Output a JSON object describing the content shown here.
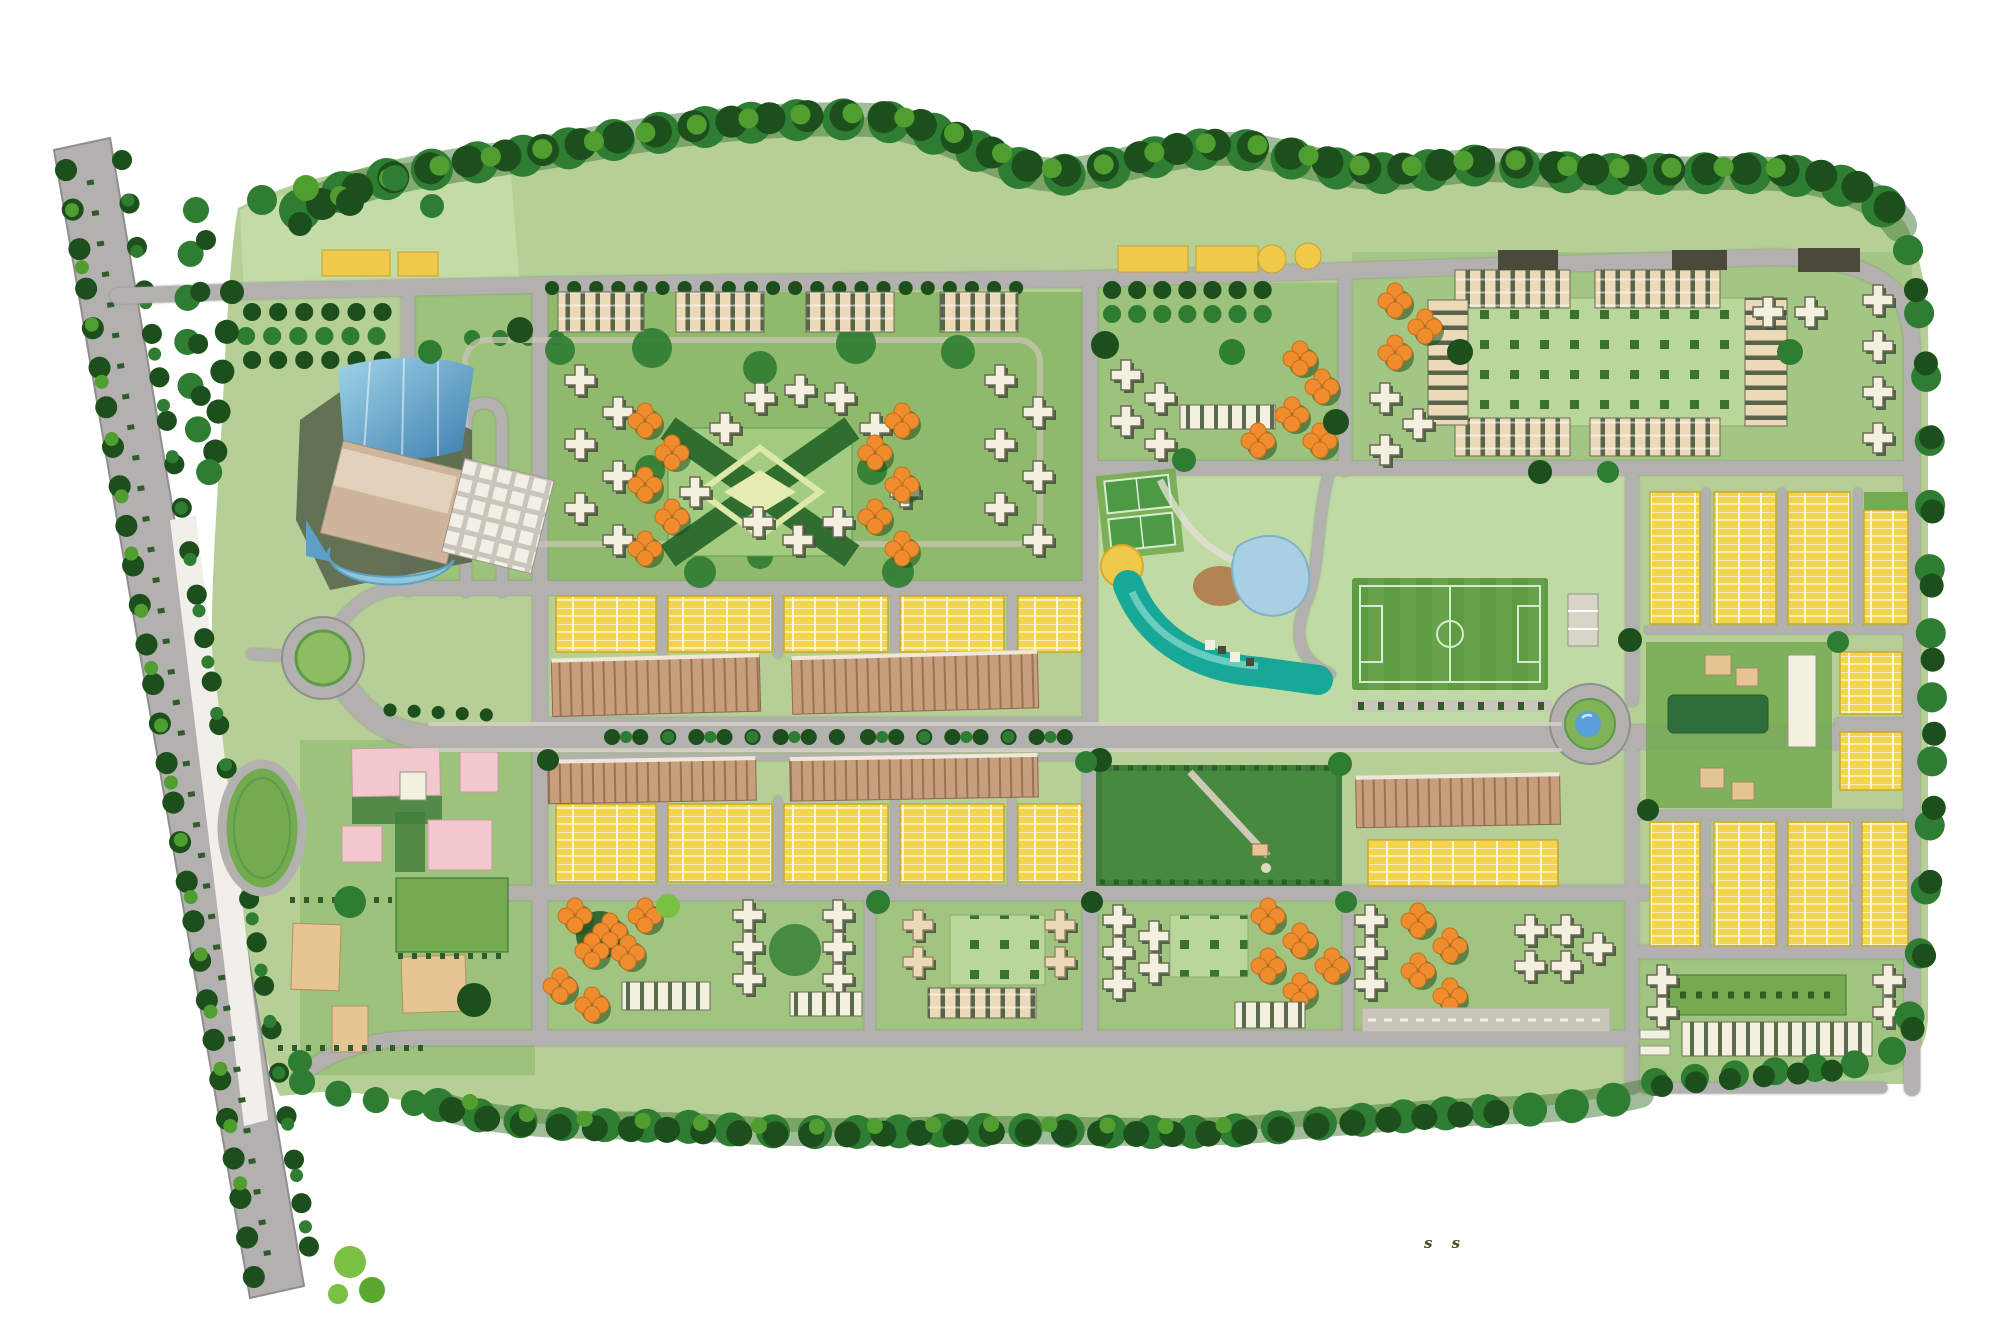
{
  "title": "township master plan",
  "annotations": {
    "plot_mark": "s s"
  },
  "colors": {
    "bg": "#ffffff",
    "grass": "#b5cf96",
    "grassLight": "#c3dca6",
    "grassMid": "#9cc27c",
    "grassDark": "#74ab50",
    "blockGreen": "#8fba6b",
    "parkDark": "#3e7d3a",
    "canopy": "#437a35",
    "treeDark": "#1d4f1d",
    "treeMid": "#2e7d32",
    "treeLight": "#4f9e2f",
    "treeLime": "#7ac143",
    "road": "#b2b1af",
    "roadEdge": "#8f8e8c",
    "lane": "#c6c3b8",
    "sidewalk": "#d6d3c8",
    "plotYellow": "#f3d44d",
    "plotLine": "#fdf6d8",
    "plotEdge": "#caa62e",
    "tan": "#c79f7c",
    "tanLine": "#9a7354",
    "bldgWhite": "#f4f0df",
    "bldgEdge": "#6b6b57",
    "bldgShadow": "#44513b",
    "beige": "#ecd9b8",
    "beigeDark": "#57644a",
    "roofDark": "#4a4a3a",
    "orange": "#ef8c2e",
    "orangeEdge": "#c96f1a",
    "pink": "#f3c7ce",
    "pinkEdge": "#c79aa4",
    "sand": "#e6c593",
    "sandEdge": "#b29260",
    "teal": "#18a898",
    "tealLight": "#7fd4c8",
    "lake": "#a8cfe2",
    "lakeEdge": "#7fb0cc",
    "pond": "#5aa0d8",
    "pool": "#8fc6da",
    "glassLight": "#9fd4e8",
    "glassDeep": "#3f7fb0",
    "amber": "#f0c84a",
    "court": "#4c9a44",
    "fieldGreen": "#5e9c41",
    "fieldLine": "#d8ead0",
    "gray": "#c9c5ba",
    "markText": "#44511c"
  },
  "features": [
    {
      "id": "greenbelt",
      "label": "perimeter tree belt"
    },
    {
      "id": "avenue",
      "label": "tree-lined approach avenue"
    },
    {
      "id": "west-roundabout",
      "label": "entry roundabout"
    },
    {
      "id": "east-roundabout",
      "label": "pond roundabout"
    },
    {
      "id": "clubhouse",
      "label": "clubhouse with pool"
    },
    {
      "id": "leisure-core",
      "label": "tennis courts, amphitheatre, leisure pool and lake"
    },
    {
      "id": "football-field",
      "label": "football field"
    },
    {
      "id": "central-park",
      "label": "central park"
    },
    {
      "id": "apartment-cluster-west",
      "label": "apartment cluster with parterre garden"
    },
    {
      "id": "apartment-cluster-northeast",
      "label": "courtyard apartment cluster"
    },
    {
      "id": "south-apartment-clusters",
      "label": "south apartment clusters"
    },
    {
      "id": "plotted-housing",
      "label": "plotted housing grids"
    },
    {
      "id": "row-houses",
      "label": "row house terraces"
    },
    {
      "id": "school",
      "label": "school campus with oval track"
    },
    {
      "id": "utility-block",
      "label": "utility and services block"
    },
    {
      "id": "orchard",
      "label": "orchard rows"
    }
  ]
}
